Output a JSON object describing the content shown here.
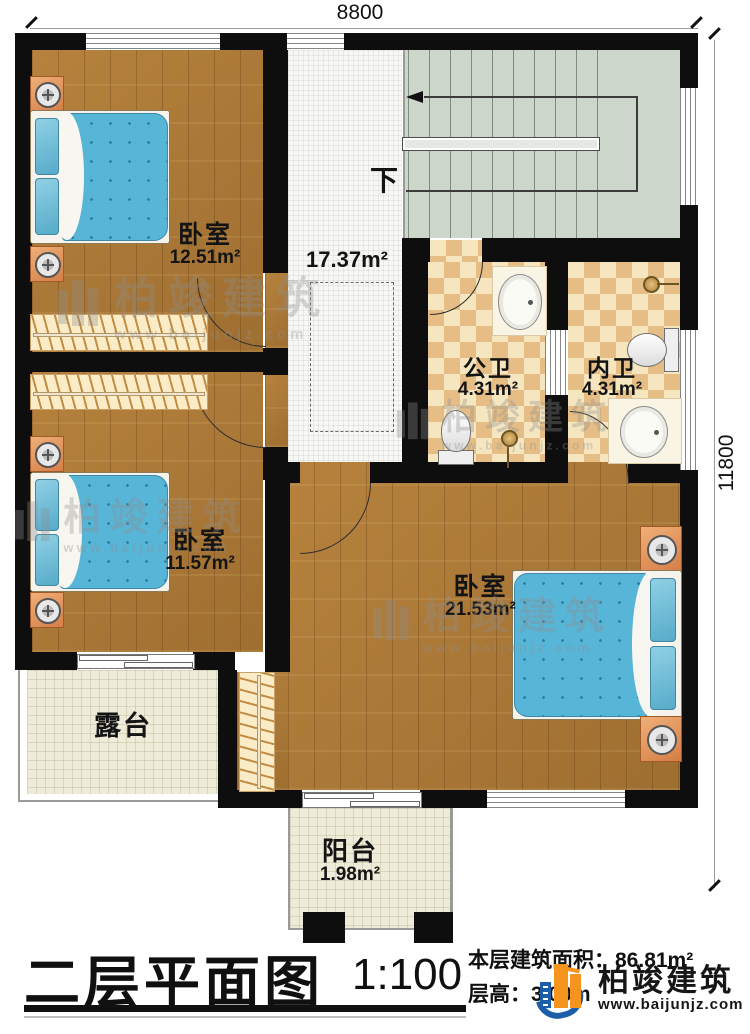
{
  "dimensions": {
    "top": "8800",
    "right": "11800"
  },
  "stairs": {
    "down_label": "下"
  },
  "rooms": {
    "bedroom_top": {
      "name": "卧室",
      "area": "12.51m²"
    },
    "bedroom_mid": {
      "name": "卧室",
      "area": "11.57m²"
    },
    "bedroom_master": {
      "name": "卧室",
      "area": "21.53m²"
    },
    "hall": {
      "area": "17.37m²"
    },
    "public_bath": {
      "name": "公卫",
      "area": "4.31m²"
    },
    "inner_bath": {
      "name": "内卫",
      "area": "4.31m²"
    },
    "terrace": {
      "name": "露台"
    },
    "balcony": {
      "name": "阳台",
      "area": "1.98m²"
    }
  },
  "title_block": {
    "title": "二层平面图",
    "scale": "1:100",
    "area_text": "本层建筑面积：86.81m²",
    "height_text": "层高：3.00m"
  },
  "brand": {
    "name": "柏竣建筑",
    "url": "www.baijunjz.com"
  },
  "watermark": {
    "name": "柏竣建筑",
    "url": "www.baijunjz.com"
  },
  "colors": {
    "wall": "#0e0e0e",
    "wood": "#ac7835",
    "stair": "#cdd6cb",
    "tile_dark": "#e5bd85",
    "mattress": "#57b5d7",
    "logo_blue": "#1c5fa8",
    "logo_orange": "#f7941d"
  }
}
